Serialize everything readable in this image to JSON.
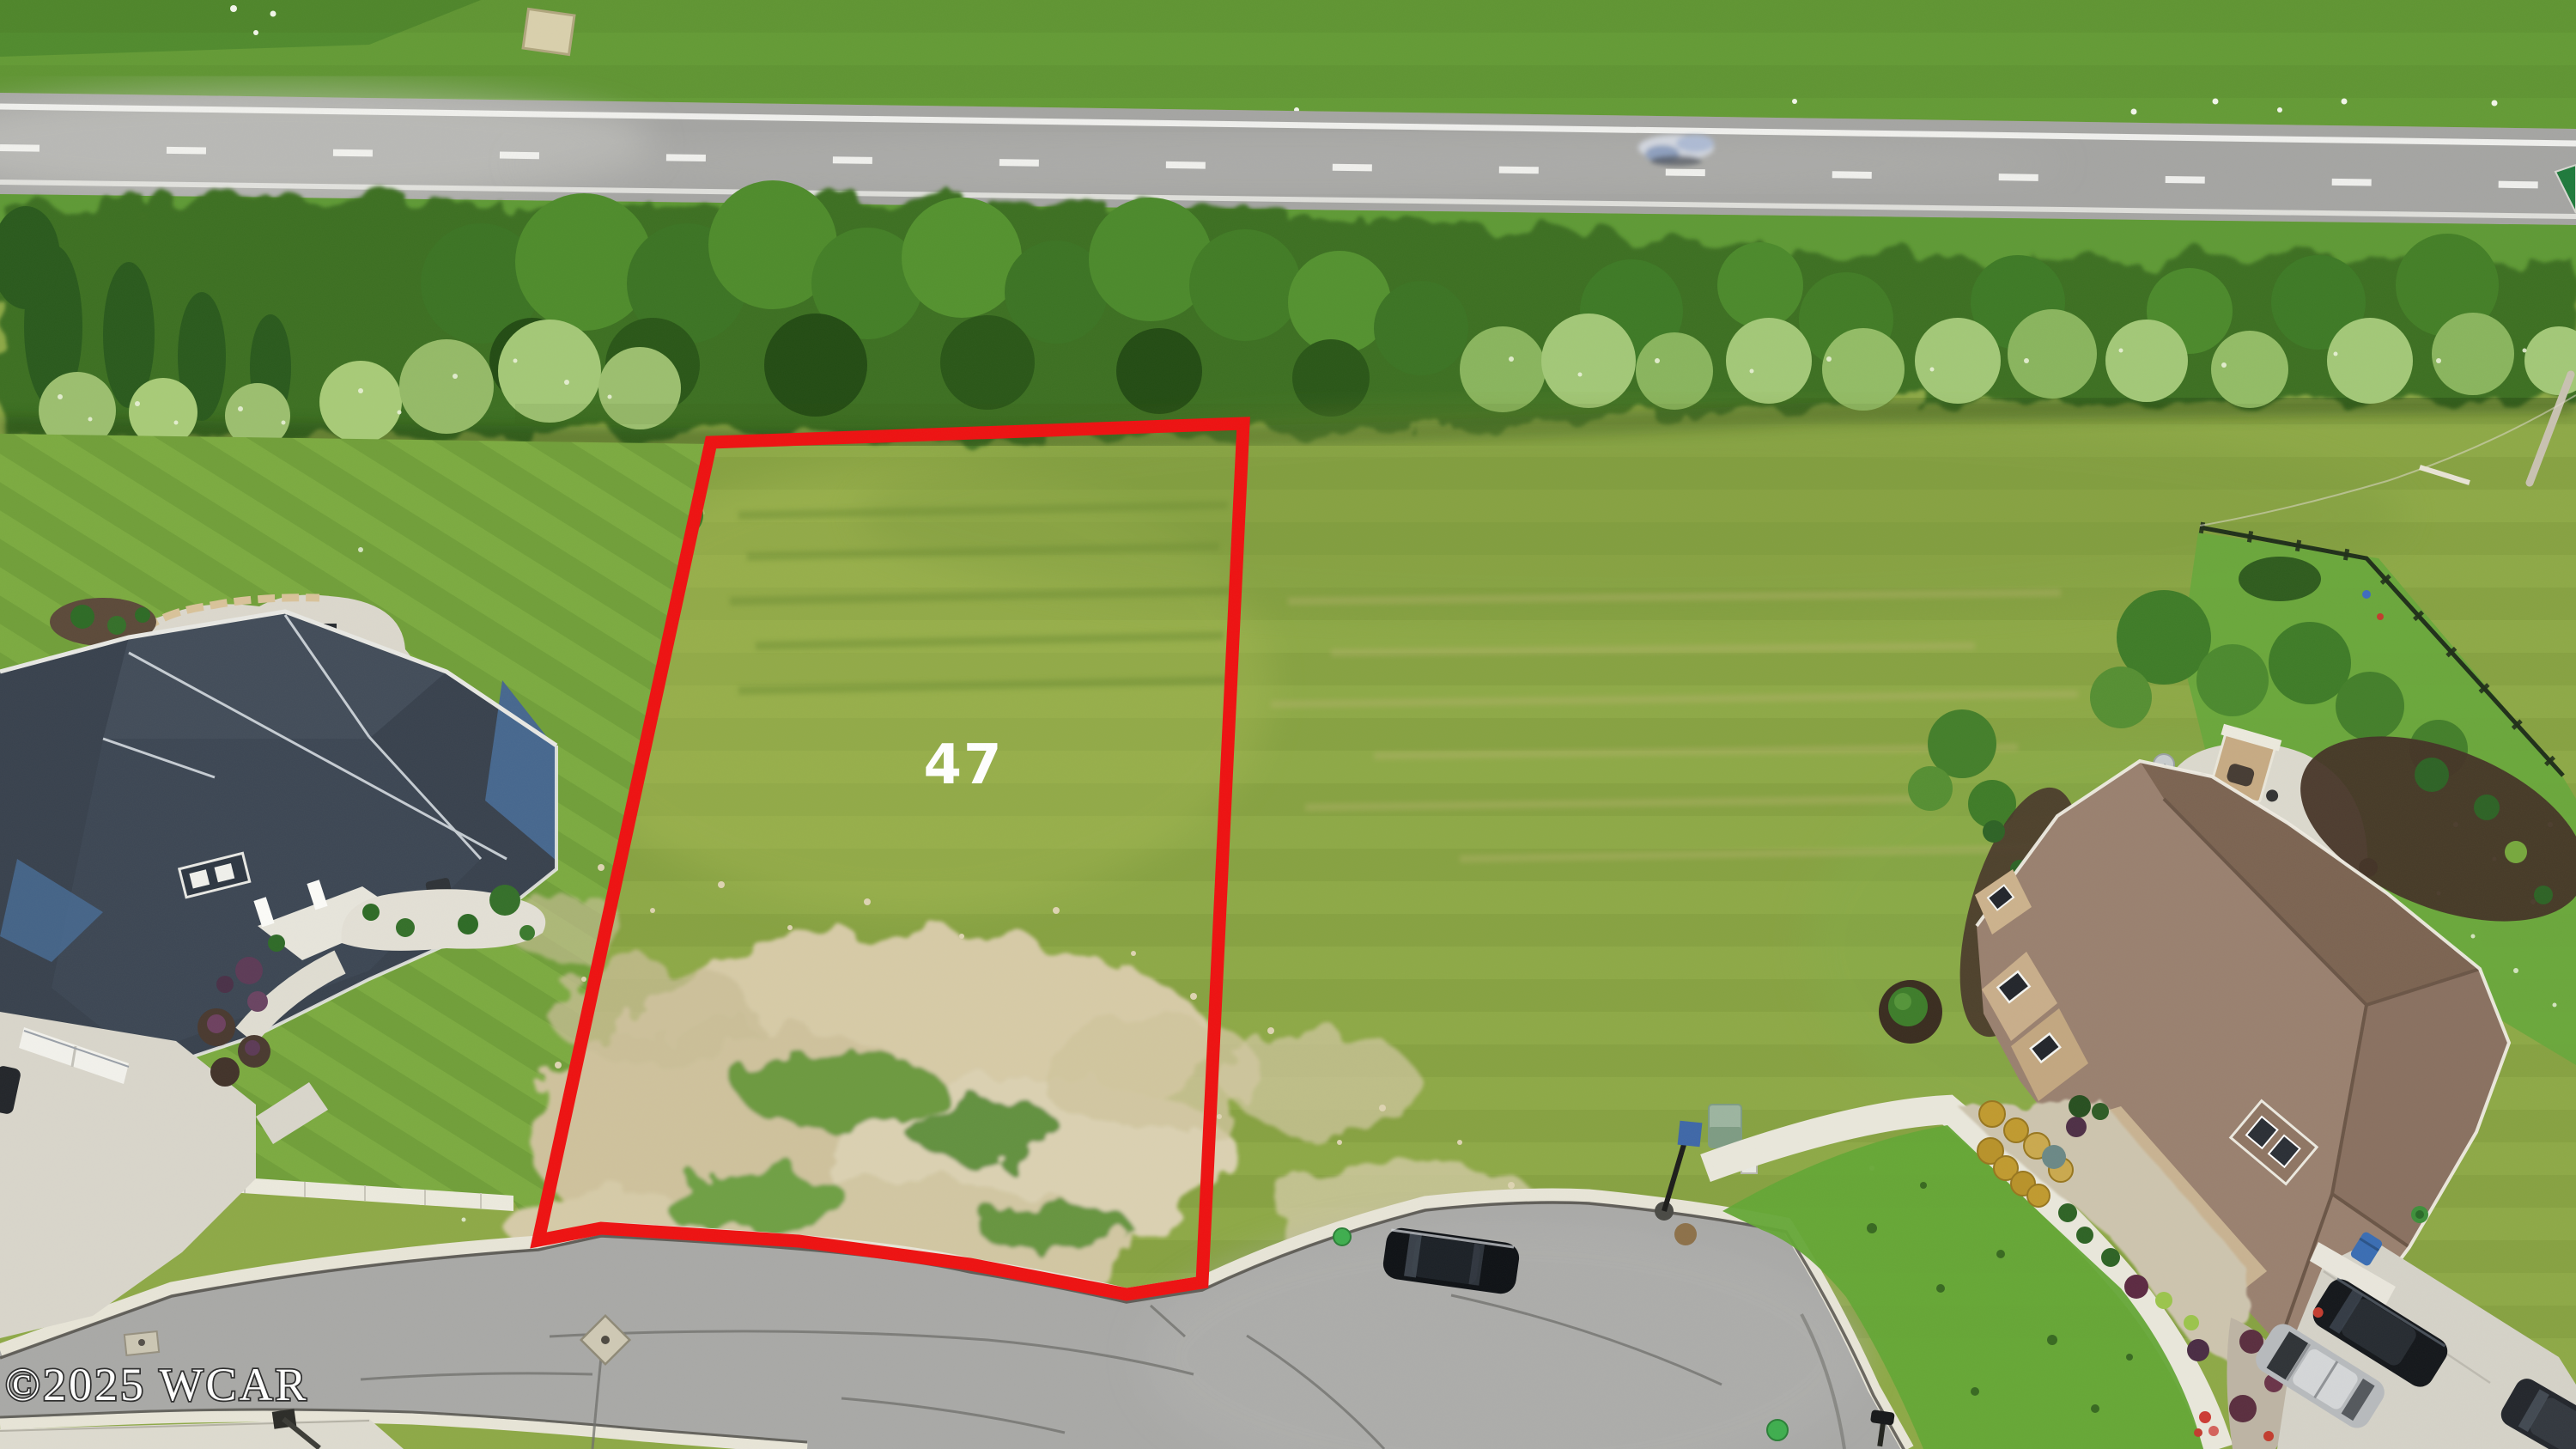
{
  "image": {
    "kind": "aerial-drone-photo",
    "subject": "vacant residential lot outlined in red between two houses, highway and tree line at top, cul-de-sac street at bottom"
  },
  "lot": {
    "label": "47",
    "label_color": "#ffffff",
    "boundary_color": "#ee1212"
  },
  "watermark": {
    "text": "©2025 WCAR",
    "color": "#ffffff",
    "outline_color": "#2e2e2e"
  },
  "scene": {
    "colors": {
      "field_grass": "#8ea947",
      "lawn_left": "#7cab41",
      "lawn_right_front": "#64a736",
      "bare_soil": "#d7cba7",
      "tree_canopy_dark": "#2c5a1d",
      "tree_canopy_mid": "#4c8a2c",
      "tree_canopy_light": "#a4c877",
      "highway_asphalt": "#a5a5a3",
      "street_asphalt": "#a9a9a7",
      "curb_concrete": "#e8e5d8",
      "sidewalk_concrete": "#eceade",
      "left_house_roof": "#3a4450",
      "left_house_siding": "#47688f",
      "right_house_roof": "#8a7161",
      "right_house_stone": "#c9b392",
      "driveway_concrete": "#d6d3c9"
    },
    "objects": [
      "highway",
      "moving-car",
      "green-road-sign",
      "tree-line",
      "vacant-lot-47",
      "lot-boundary",
      "bare-soil-patches",
      "left-house",
      "left-patio-fire-pit",
      "left-driveway",
      "street",
      "cul-de-sac",
      "street-parked-car",
      "lamp-post",
      "utility-cabinet",
      "utility-marker",
      "manhole-covers",
      "right-house",
      "outdoor-fireplace",
      "backyard-fence",
      "right-driveway",
      "silver-suv",
      "black-sedan",
      "corner-car",
      "trash-bin",
      "mailboxes",
      "watermark"
    ]
  }
}
